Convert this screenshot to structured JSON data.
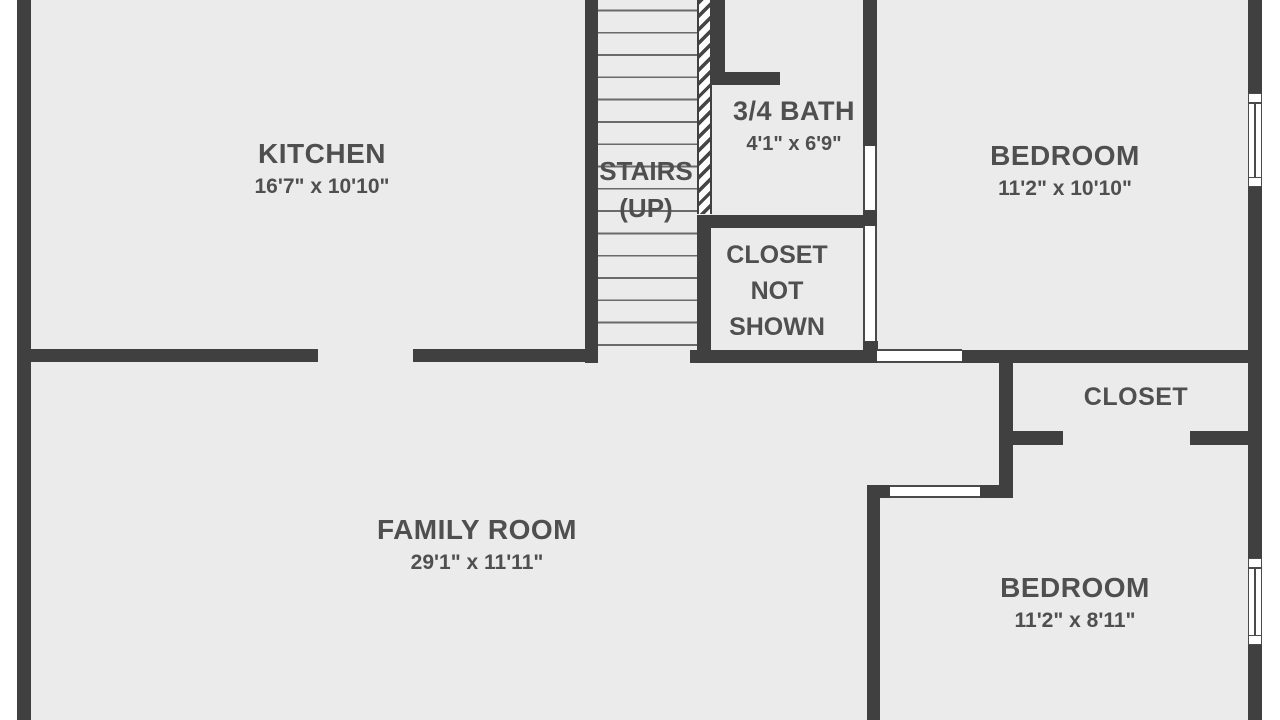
{
  "colors": {
    "background": "#ffffff",
    "floor": "#ebebeb",
    "wall": "#404040",
    "text": "#4f4f4f"
  },
  "rooms": {
    "kitchen": {
      "name": "KITCHEN",
      "dimensions": "16'7\" x 10'10\""
    },
    "stairs": {
      "name": "STAIRS",
      "direction": "(UP)"
    },
    "bath": {
      "name": "3/4 BATH",
      "dimensions": "4'1\" x 6'9\""
    },
    "bedroom1": {
      "name": "BEDROOM",
      "dimensions": "11'2\" x 10'10\""
    },
    "closet_note": {
      "name": "CLOSET NOT SHOWN"
    },
    "closet": {
      "name": "CLOSET"
    },
    "family_room": {
      "name": "FAMILY ROOM",
      "dimensions": "29'1\" x 11'11\""
    },
    "bedroom2": {
      "name": "BEDROOM",
      "dimensions": "11'2\" x 8'11\""
    }
  }
}
